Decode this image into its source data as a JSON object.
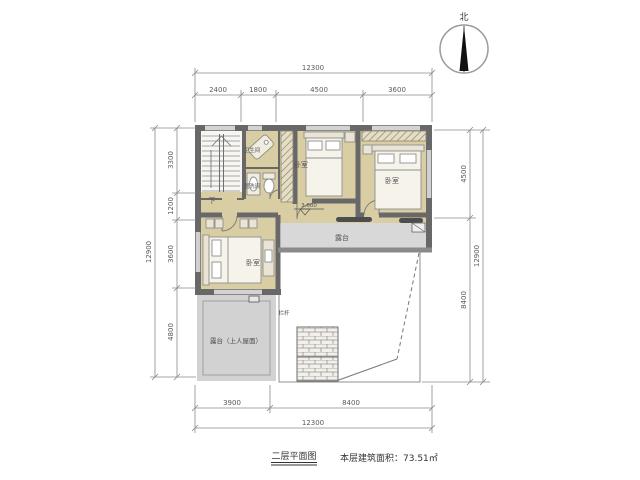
{
  "title": "二层平面图",
  "north": {
    "label": "北"
  },
  "dimensions": {
    "top": {
      "overall": "12300",
      "segments": [
        "2400",
        "1800",
        "4500",
        "3600"
      ]
    },
    "bottom": {
      "overall": "12300",
      "segments": [
        "3900",
        "8400"
      ]
    },
    "left": {
      "overall": "12900",
      "segments": [
        "3300",
        "1200",
        "3600",
        "4800"
      ]
    },
    "right": {
      "overall": "12900",
      "segments": [
        "4500",
        "8400"
      ]
    }
  },
  "rooms": {
    "bedroom1": "卧室",
    "bedroom2": "卧室",
    "bedroom3": "卧室",
    "terrace": "露台",
    "roof_terrace": "露台（上人屋面）",
    "bathroom": "卫生间",
    "washroom": "盥洗间",
    "stair_down": "下",
    "railing": "栏杆",
    "level_mark": "3.600"
  },
  "caption": {
    "plan_title": "二层平面图",
    "area_text": "本层建筑面积：73.51㎡"
  },
  "colors": {
    "wall": "#686868",
    "floor": "#d9cda4",
    "terrace": "#d8d8d8",
    "roof_terrace": "#d2d2d2",
    "needle": "#111111",
    "dim_line": "#777777"
  }
}
